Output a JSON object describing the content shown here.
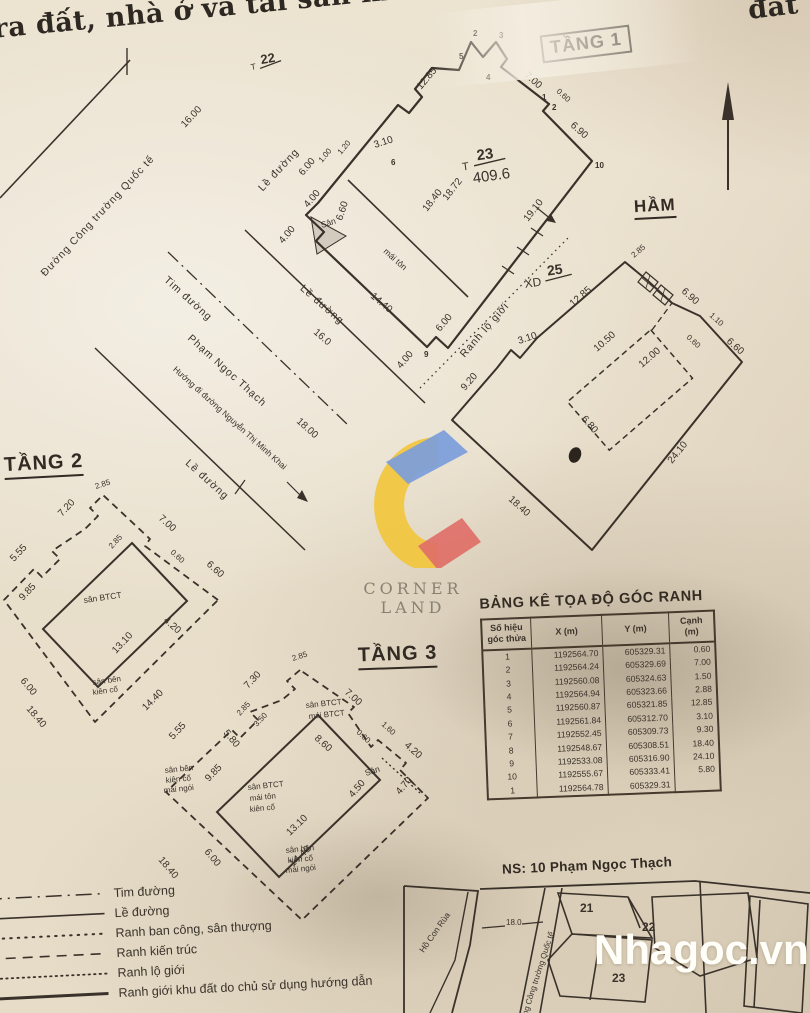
{
  "header": {
    "title": "ra đất, nhà ở và tài sản khác gắn",
    "corner_fragment": "đất"
  },
  "streets": {
    "cong_truong_quoc_te": "Đường Công trường Quốc tế",
    "w16": "16.00",
    "tim_duong": "Tim đường",
    "pham_ngoc_thach": "Phạm Ngọc Thạch",
    "huong_di": "Hướng đi đường Nguyễn Thị Minh Khai",
    "le_duong_a": "Lề đường",
    "le_duong_b": "Lề đường",
    "le_duong_c": "Lề đường",
    "w18": "18.00"
  },
  "tang1": {
    "label": "TẦNG 1",
    "plot22": {
      "prefix": "T",
      "num": "22"
    },
    "plot23": {
      "prefix": "T",
      "num": "23",
      "area": "409.6"
    },
    "xd25": {
      "prefix": "XD",
      "num": "25"
    },
    "dims": [
      "12.85",
      "7.00",
      "0.60",
      "6.90",
      "19.10",
      "3.10",
      "1.00",
      "1.20",
      "6.00",
      "4.00",
      "6.60",
      "4.00",
      "18.40",
      "18.72",
      "14.40",
      "16.0",
      "6.00",
      "4.00"
    ],
    "san": "Sân",
    "mai_ton": "mái tôn",
    "points": [
      "2",
      "3",
      "4",
      "5",
      "6",
      "1",
      "2",
      "10",
      "9"
    ]
  },
  "ham": {
    "label": "HẦM",
    "ranh_lo_gioi": "Ranh lộ giới",
    "dims": [
      "2.85",
      "12.85",
      "10.50",
      "6.90",
      "1.10",
      "6.60",
      "0.60",
      "12.00",
      "6.80",
      "3.10",
      "9.20",
      "24.10",
      "18.40"
    ]
  },
  "tang2": {
    "label": "TẦNG 2",
    "dims": [
      "2.85",
      "7.20",
      "7.00",
      "0.60",
      "6.60",
      "2.85",
      "5.55",
      "9.85",
      "4.20",
      "13.10",
      "6.00",
      "18.40",
      "14.40",
      "5.80"
    ],
    "texts": [
      "sân BTCT",
      "sân bên",
      "kiên cố"
    ]
  },
  "tang3": {
    "label": "TẦNG 3",
    "dims": [
      "2.85",
      "7.30",
      "7.00",
      "1.60",
      "4.20",
      "0.60",
      "4.70",
      "4.50",
      "5.55",
      "2.85",
      "3.50",
      "9.85",
      "8.60",
      "13.10",
      "6.00",
      "18.40",
      "14.40"
    ],
    "texts": [
      "sân BTCT",
      "mái BTCT",
      "Sân",
      "sân BTCT",
      "mái tôn",
      "kiên cố",
      "sân bên",
      "kiên cố",
      "mái ngói",
      "sân bên",
      "kiên cố",
      "mái ngói"
    ]
  },
  "table": {
    "title": "BẢNG KÊ TỌA ĐỘ GÓC RANH",
    "headers": [
      "Số hiệu\ngóc thửa",
      "X (m)",
      "Y (m)",
      "Cạnh\n(m)"
    ],
    "rows": [
      [
        "1",
        "1192564.70",
        "605329.31",
        "0.60"
      ],
      [
        "2",
        "1192564.24",
        "605329.69",
        "7.00"
      ],
      [
        "3",
        "1192560.08",
        "605324.63",
        "1.50"
      ],
      [
        "4",
        "1192564.94",
        "605323.66",
        "2.88"
      ],
      [
        "5",
        "1192560.87",
        "605321.85",
        "12.85"
      ],
      [
        "6",
        "1192561.84",
        "605312.70",
        "3.10"
      ],
      [
        "7",
        "1192552.45",
        "605309.73",
        "9.30"
      ],
      [
        "8",
        "1192548.67",
        "605308.51",
        "18.40"
      ],
      [
        "9",
        "1192533.08",
        "605316.90",
        "24.10"
      ],
      [
        "10",
        "1192555.67",
        "605333.41",
        "5.80"
      ],
      [
        "1",
        "1192564.78",
        "605329.31",
        ""
      ]
    ]
  },
  "legend": {
    "items": [
      "Tim đường",
      "Lề đường",
      "Ranh ban công, sân thượng",
      "Ranh kiến trúc",
      "Ranh lộ giới",
      "Ranh giới khu đất do chủ sử dụng hướng dẫn"
    ]
  },
  "inset": {
    "title": "NS: 10 Phạm Ngọc Thạch",
    "ho_con_rua": "Hồ Con Rùa",
    "street": "Đường Công trường Quốc tế",
    "w18": "18.0",
    "parcels": [
      "21",
      "22",
      "23"
    ]
  },
  "branding": {
    "logo_text": "CORNER LAND",
    "watermark": "Nhagoc.vn"
  },
  "colors": {
    "ink": "#3a322a",
    "paper": "#eae1cf",
    "logo_blue": "#7b9ddb",
    "logo_yellow": "#f2c53d",
    "logo_red": "#df6f68",
    "watermark_color": "#fffef8"
  }
}
